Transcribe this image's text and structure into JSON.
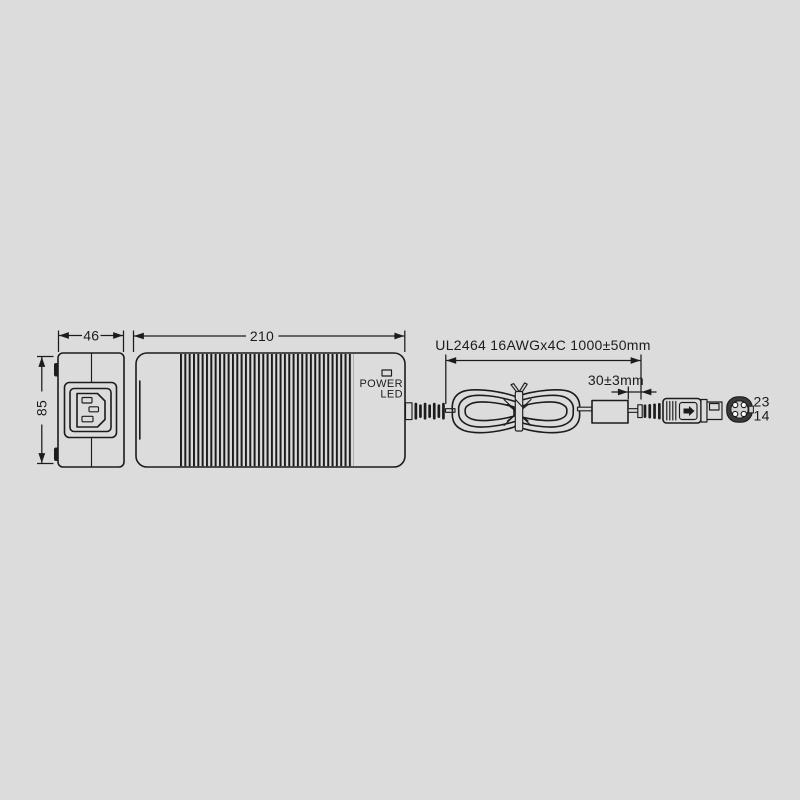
{
  "colors": {
    "background": "#dcdcdc",
    "line": "#1c1c1c"
  },
  "front_view": {
    "width_dim": "46",
    "height_dim": "85"
  },
  "side_view": {
    "length_dim": "210",
    "indicator_label_line1": "POWER",
    "indicator_label_line2": "LED"
  },
  "output_cable": {
    "spec_dim": "UL2464 16AWGx4C 1000±50mm",
    "bead_to_plug_dim": "30±3mm"
  },
  "dc_plug_end_view": {
    "pin_numbers_top": "23",
    "pin_numbers_bottom": "14"
  }
}
